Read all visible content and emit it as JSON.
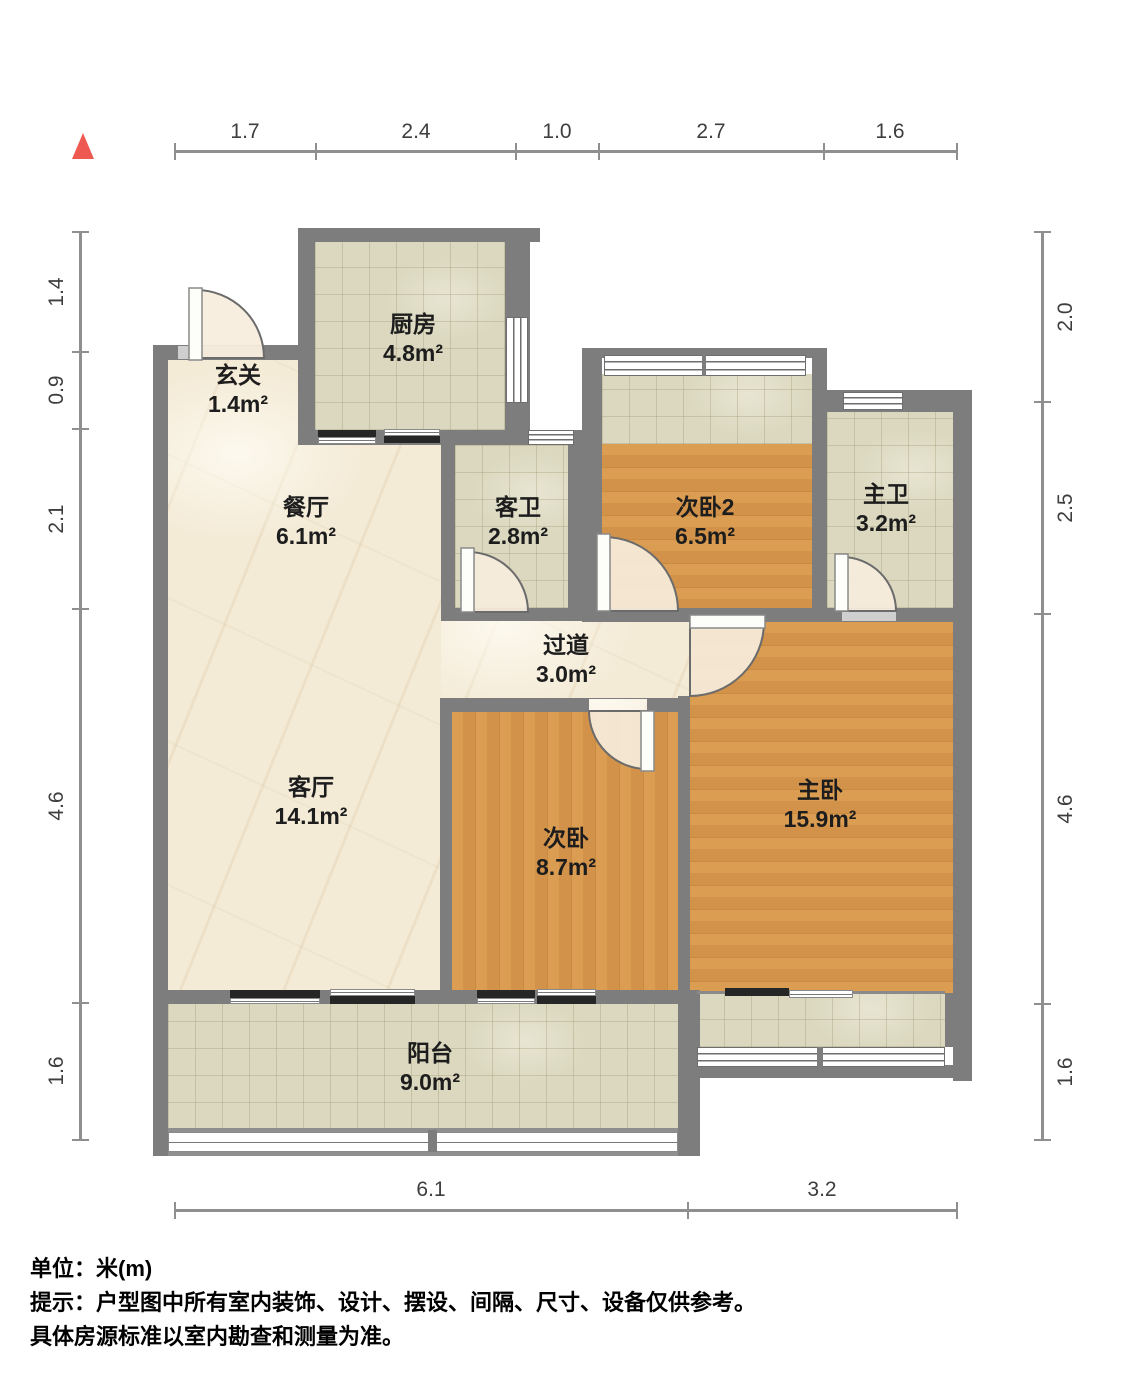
{
  "title": "户型图",
  "north_indicator": "north-triangle",
  "dimensions": {
    "unit_note": "米",
    "top": [
      "1.7",
      "2.4",
      "1.0",
      "2.7",
      "1.6"
    ],
    "left": [
      "1.4",
      "0.9",
      "2.1",
      "4.6",
      "1.6"
    ],
    "right": [
      "2.0",
      "2.5",
      "4.6",
      "1.6"
    ],
    "bottom": [
      "6.1",
      "3.2"
    ]
  },
  "rooms": [
    {
      "name": "厨房",
      "area": "4.8m²"
    },
    {
      "name": "玄关",
      "area": "1.4m²"
    },
    {
      "name": "餐厅",
      "area": "6.1m²"
    },
    {
      "name": "客卫",
      "area": "2.8m²"
    },
    {
      "name": "次卧2",
      "area": "6.5m²"
    },
    {
      "name": "主卫",
      "area": "3.2m²"
    },
    {
      "name": "过道",
      "area": "3.0m²"
    },
    {
      "name": "客厅",
      "area": "14.1m²"
    },
    {
      "name": "次卧",
      "area": "8.7m²"
    },
    {
      "name": "主卧",
      "area": "15.9m²"
    },
    {
      "name": "阳台",
      "area": "9.0m²"
    }
  ],
  "footer": {
    "line1": "单位：米(m)",
    "line2": "提示：户型图中所有室内装饰、设计、摆设、间隔、尺寸、设备仅供参考。",
    "line3": "具体房源标准以室内勘查和测量为准。"
  },
  "colors": {
    "wall": "#7d7d7d",
    "wood_floor": "#d89a4f",
    "tile_floor": "#dbd8bf",
    "marble_floor": "#f4ebd7",
    "north_arrow": "#ee5a52",
    "frame_black": "#262626",
    "dimension": "#8f8f8f"
  }
}
